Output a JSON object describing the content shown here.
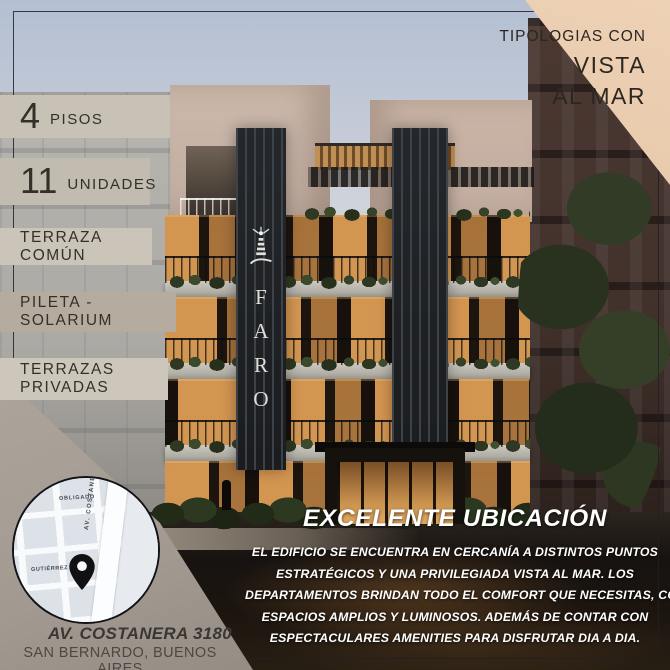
{
  "banner": {
    "line1": "TIPOLOGIAS CON",
    "line2": "VISTA",
    "line3": "AL MAR"
  },
  "badges": [
    {
      "value": "4",
      "label": "PISOS"
    },
    {
      "value": "11",
      "label": "UNIDADES"
    },
    {
      "label": "TERRAZA COMÚN"
    },
    {
      "label": "PILETA - SOLARIUM"
    },
    {
      "label": "TERRAZAS PRIVADAS"
    }
  ],
  "building_sign": {
    "icon": "lighthouse-icon",
    "letters": [
      "F",
      "A",
      "R",
      "O"
    ]
  },
  "map": {
    "street_top": "OBLIGADO",
    "street_main": "AV. COSTANERA",
    "street_left": "GUTIÉRREZ",
    "pin_icon": "map-pin-icon"
  },
  "address": {
    "line1": "AV. COSTANERA 3180",
    "line2": "SAN BERNARDO, BUENOS AIRES"
  },
  "location": {
    "title": "EXCELENTE UBICACIÓN",
    "lines": [
      "EL EDIFICIO SE ENCUENTRA EN CERCANÍA A DISTINTOS PUNTOS",
      "ESTRATÉGICOS Y UNA PRIVILEGIADA VISTA AL MAR. LOS",
      "DEPARTAMENTOS BRINDAN TODO EL COMFORT QUE NECESITAS, CON",
      "ESPACIOS AMPLIOS Y LUMINOSOS. ADEMÁS DE CONTAR CON",
      "ESPECTACULARES AMENITIES PARA DISFRUTAR DIA A DIA."
    ]
  },
  "colors": {
    "banner_bg": "#e5c5a9",
    "badge_bg": "#c7c0b4",
    "panel_bg": "#a29a91",
    "text_dark": "#2e2a25",
    "text_light": "#ffffff",
    "window_glow": "#d09a58"
  }
}
